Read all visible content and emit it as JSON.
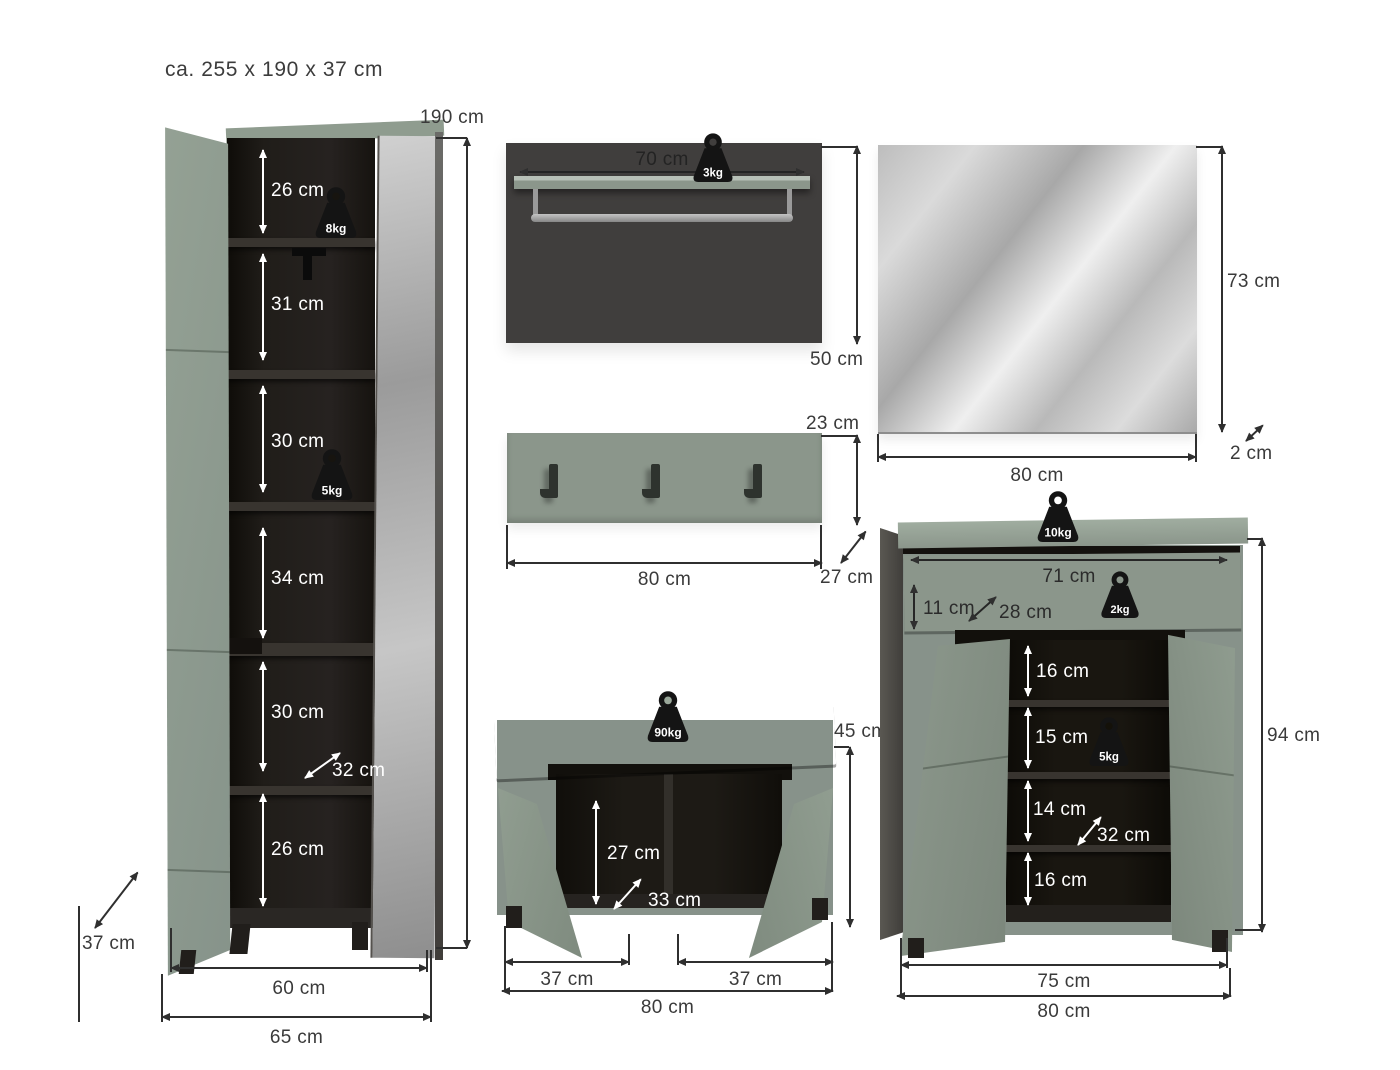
{
  "title": "ca. 255 x 190 x 37 cm",
  "colors": {
    "sage_green": "#8b968b",
    "sage_green_light": "#9dab9d",
    "panel_dark": "#403e3d",
    "interior_dark": "#1b1815",
    "mirror_silver": "#c9c9c9",
    "dimension_line": "#2f2f2f",
    "label_text": "#3a3a3a",
    "weight_icon": "#141414"
  },
  "wardrobe": {
    "height_label": "190 cm",
    "depth_label": "37 cm",
    "door_width_label": "60 cm",
    "total_width_label": "65 cm",
    "inner_depth_label": "32 cm",
    "compartments": [
      "26 cm",
      "31 cm",
      "30 cm",
      "34 cm",
      "30 cm",
      "26 cm"
    ],
    "load_top": "8kg",
    "load_mid": "5kg"
  },
  "wall_panel": {
    "shelf_width_label": "70 cm",
    "height_label": "50 cm",
    "load": "3kg"
  },
  "coat_rack": {
    "height_label": "23 cm",
    "width_label": "80 cm",
    "depth_label": "27 cm"
  },
  "mirror": {
    "height_label": "73 cm",
    "width_label": "80 cm",
    "depth_label": "2 cm"
  },
  "bench": {
    "load": "90kg",
    "height_label": "45 cm",
    "inner_height_label": "27 cm",
    "inner_depth_label": "33 cm",
    "left_width_label": "37 cm",
    "right_width_label": "37 cm",
    "width_label": "80 cm"
  },
  "shoe_cabinet": {
    "load_top": "10kg",
    "drawer_width_label": "71 cm",
    "drawer_height_label": "11 cm",
    "drawer_depth_label": "28 cm",
    "drawer_load": "2kg",
    "shelves": [
      "16 cm",
      "15 cm",
      "14 cm",
      "16 cm"
    ],
    "shelf_load": "5kg",
    "inner_depth_label": "32 cm",
    "height_label": "94 cm",
    "inner_width_label": "75 cm",
    "width_label": "80 cm"
  }
}
